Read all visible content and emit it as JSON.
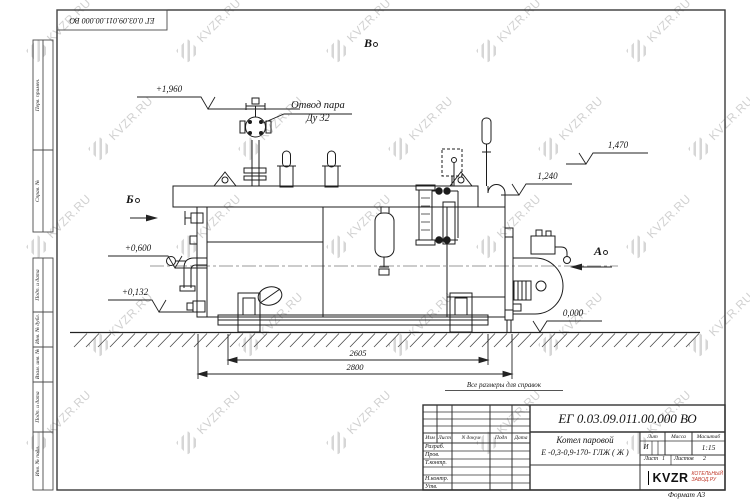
{
  "watermark": {
    "text": "KVZR.RU"
  },
  "top_stamp": {
    "designation": "ЕГ 0.03.09.011.00.000  ВО"
  },
  "frame_left_labels": [
    "Перв. примен.",
    "Справ. №",
    "Подп. и дата",
    "Инв. № дубл.",
    "Взам. инв. №",
    "Подп. и дата",
    "Инв. № подл."
  ],
  "drawing": {
    "callout_line1": "Отвод пара",
    "callout_line2": "Ду 32",
    "elevations": [
      "+1,960",
      "+0,600",
      "+0,132",
      "1,470",
      "1,240",
      "0,000"
    ],
    "dimensions": [
      "2605",
      "2800"
    ],
    "views": {
      "b": "Б",
      "v": "В",
      "a": "А"
    },
    "note": "Все размеры для справок"
  },
  "title_block": {
    "designation": "ЕГ 0.03.09.011.00.000  ВО",
    "product_name": "Котел паровой",
    "product_type": "Е -0,3-0,9-170- ГЛЖ ( Ж )",
    "header_cols": [
      "Изм",
      "Лист",
      "N докум",
      "Подп",
      "Дата"
    ],
    "sign_rows": [
      "Разраб.",
      "Пров.",
      "Т.контр.",
      "Н.контр.",
      "Утв."
    ],
    "lit_label": "Лит",
    "mass_label": "Масса",
    "scale_label": "Масштаб",
    "lit_value": "И",
    "scale_value": "1:15",
    "sheet_label": "Лист",
    "sheet_num": "1",
    "sheets_label": "Листов",
    "sheets_num": "2",
    "logo_text": "KVZR",
    "logo_sub1": "КОТЕЛЬНЫЙ",
    "logo_sub2": "ЗАВОД.РУ",
    "format_label": "Формат А3"
  }
}
